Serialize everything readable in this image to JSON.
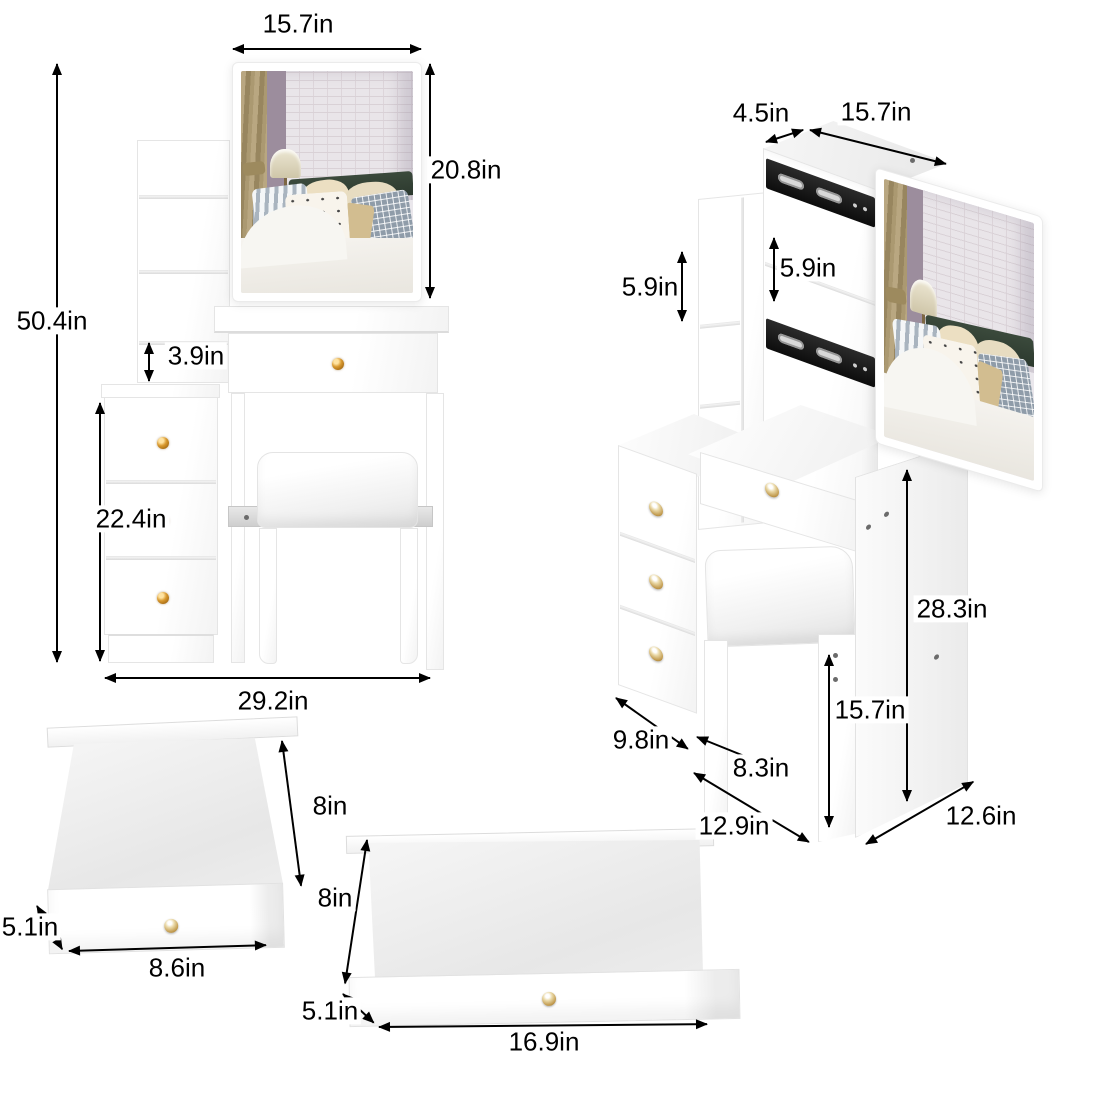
{
  "colors": {
    "background": "#ffffff",
    "dimension_text": "#000000",
    "knob_gold": "#c8861e",
    "rail_black": "#141414",
    "beam_silver": "#d9d9d9",
    "furniture_white": "#ffffff"
  },
  "dimensions": {
    "front": {
      "mirror_width": "15.7in",
      "mirror_height": "20.8in",
      "total_height": "50.4in",
      "shelf_gap": "3.9in",
      "cabinet_height": "22.4in",
      "total_width": "29.2in"
    },
    "side": {
      "top_depth": "4.5in",
      "mirror_width": "15.7in",
      "shelf_left": "5.9in",
      "shelf_right": "5.9in",
      "desk_height": "28.3in",
      "stool_height": "15.7in",
      "cabinet_depth": "9.8in",
      "stool_width": "8.3in",
      "base_depth": "12.9in",
      "panel_depth": "12.6in"
    },
    "small_drawer": {
      "depth": "8in",
      "height": "5.1in",
      "width": "8.6in"
    },
    "large_drawer": {
      "depth": "8in",
      "height": "5.1in",
      "width": "16.9in"
    }
  }
}
